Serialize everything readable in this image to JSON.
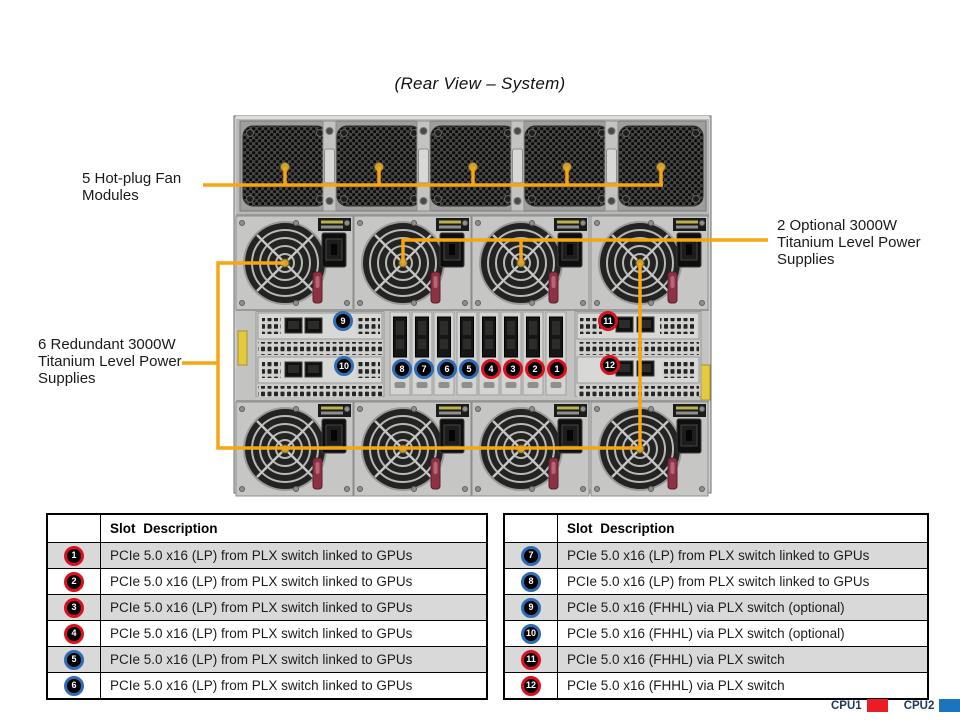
{
  "page": {
    "title": "(Rear View – System)"
  },
  "callouts": {
    "fan": "5 Hot-plug Fan Modules",
    "optional_psu": "2 Optional 3000W Titanium Level Power Supplies",
    "redundant_psu": "6 Redundant 3000W Titanium Level Power Supplies"
  },
  "table_header": "Slot Description",
  "slots": [
    {
      "num": 1,
      "group": "cpu1",
      "desc": "PCIe 5.0 x16 (LP) from PLX switch linked to GPUs"
    },
    {
      "num": 2,
      "group": "cpu1",
      "desc": "PCIe 5.0 x16 (LP) from PLX switch linked to GPUs"
    },
    {
      "num": 3,
      "group": "cpu1",
      "desc": "PCIe 5.0 x16 (LP) from PLX switch linked to GPUs"
    },
    {
      "num": 4,
      "group": "cpu1",
      "desc": "PCIe 5.0 x16 (LP) from PLX switch linked to GPUs"
    },
    {
      "num": 5,
      "group": "cpu2",
      "desc": "PCIe 5.0 x16 (LP) from PLX switch linked to GPUs"
    },
    {
      "num": 6,
      "group": "cpu2",
      "desc": "PCIe 5.0 x16 (LP) from PLX switch linked to GPUs"
    },
    {
      "num": 7,
      "group": "cpu2",
      "desc": "PCIe 5.0 x16 (LP) from PLX switch linked to GPUs"
    },
    {
      "num": 8,
      "group": "cpu2",
      "desc": "PCIe 5.0 x16 (LP) from PLX switch linked to GPUs"
    },
    {
      "num": 9,
      "group": "cpu2",
      "desc": "PCIe 5.0 x16 (FHHL) via PLX switch (optional)"
    },
    {
      "num": 10,
      "group": "cpu2",
      "desc": "PCIe 5.0 x16 (FHHL) via PLX switch (optional)"
    },
    {
      "num": 11,
      "group": "cpu1",
      "desc": "PCIe 5.0 x16 (FHHL) via PLX switch"
    },
    {
      "num": 12,
      "group": "cpu1",
      "desc": "PCIe 5.0 x16 (FHHL) via PLX switch"
    }
  ],
  "legend": {
    "cpu1_label": "CPU1",
    "cpu2_label": "CPU2"
  },
  "colors": {
    "accent_orange": "#F7A511",
    "slot_red": "#DE0F1E",
    "slot_blue": "#2E6CB5",
    "row_shade": "#D9D9D9",
    "cpu1_swatch": "#EC1C24",
    "cpu2_swatch": "#1C75BC",
    "legend_text": "#1F3864"
  }
}
